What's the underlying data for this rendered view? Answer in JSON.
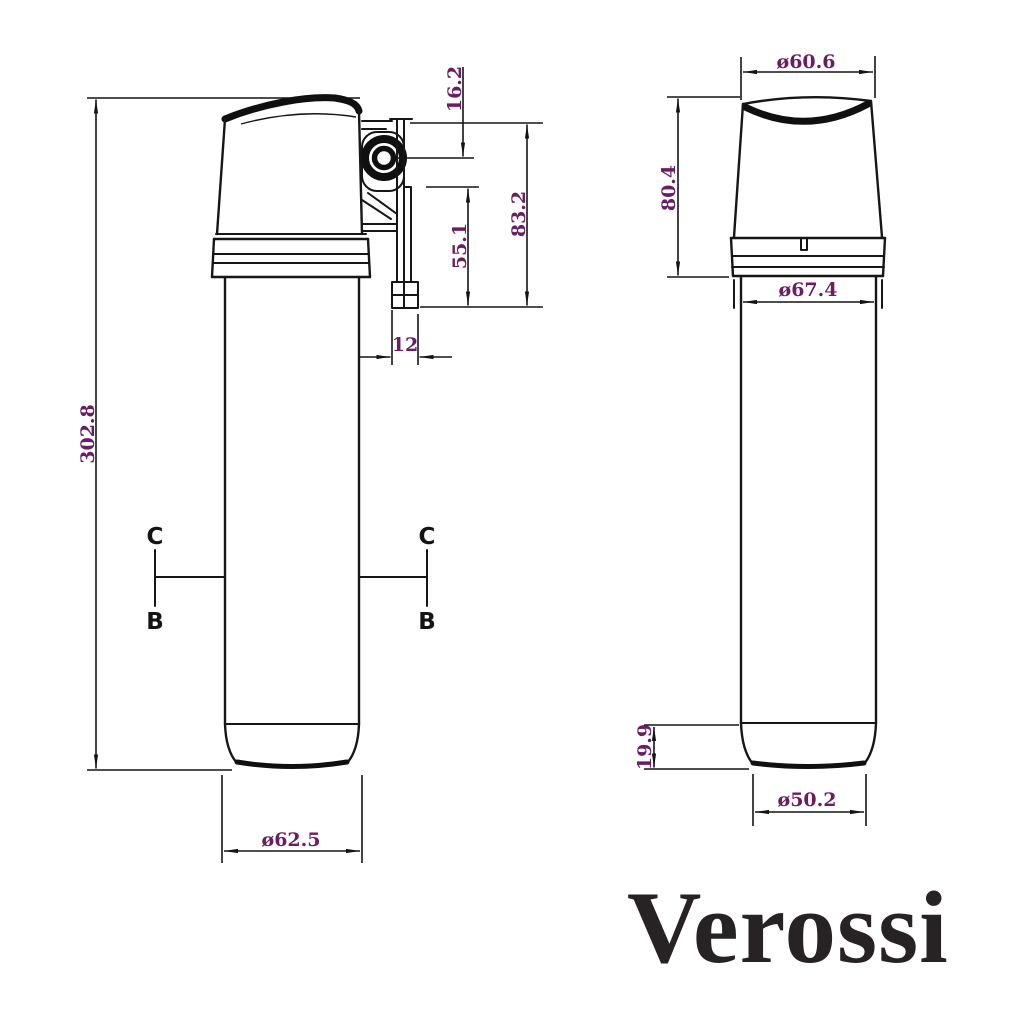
{
  "page": {
    "background": "#ffffff"
  },
  "colors": {
    "line": "#161616",
    "dimension_text": "#6b1d63",
    "brand_text": "#272223"
  },
  "brand": {
    "name": "Verossi"
  },
  "side_view": {
    "dimensions": {
      "overall_height": "302.8",
      "port_center_offset": "16.2",
      "head_assembly_height": "83.2",
      "bracket_plate_height": "55.1",
      "bracket_thickness": "12",
      "body_diameter": "ø62.5"
    },
    "section_markers": [
      {
        "top": "C",
        "bottom": "B"
      },
      {
        "top": "C",
        "bottom": "B"
      }
    ]
  },
  "front_view": {
    "dimensions": {
      "top_diameter": "ø60.6",
      "head_height": "80.4",
      "collar_diameter": "ø67.4",
      "base_height": "19.9",
      "base_diameter": "ø50.2"
    }
  }
}
